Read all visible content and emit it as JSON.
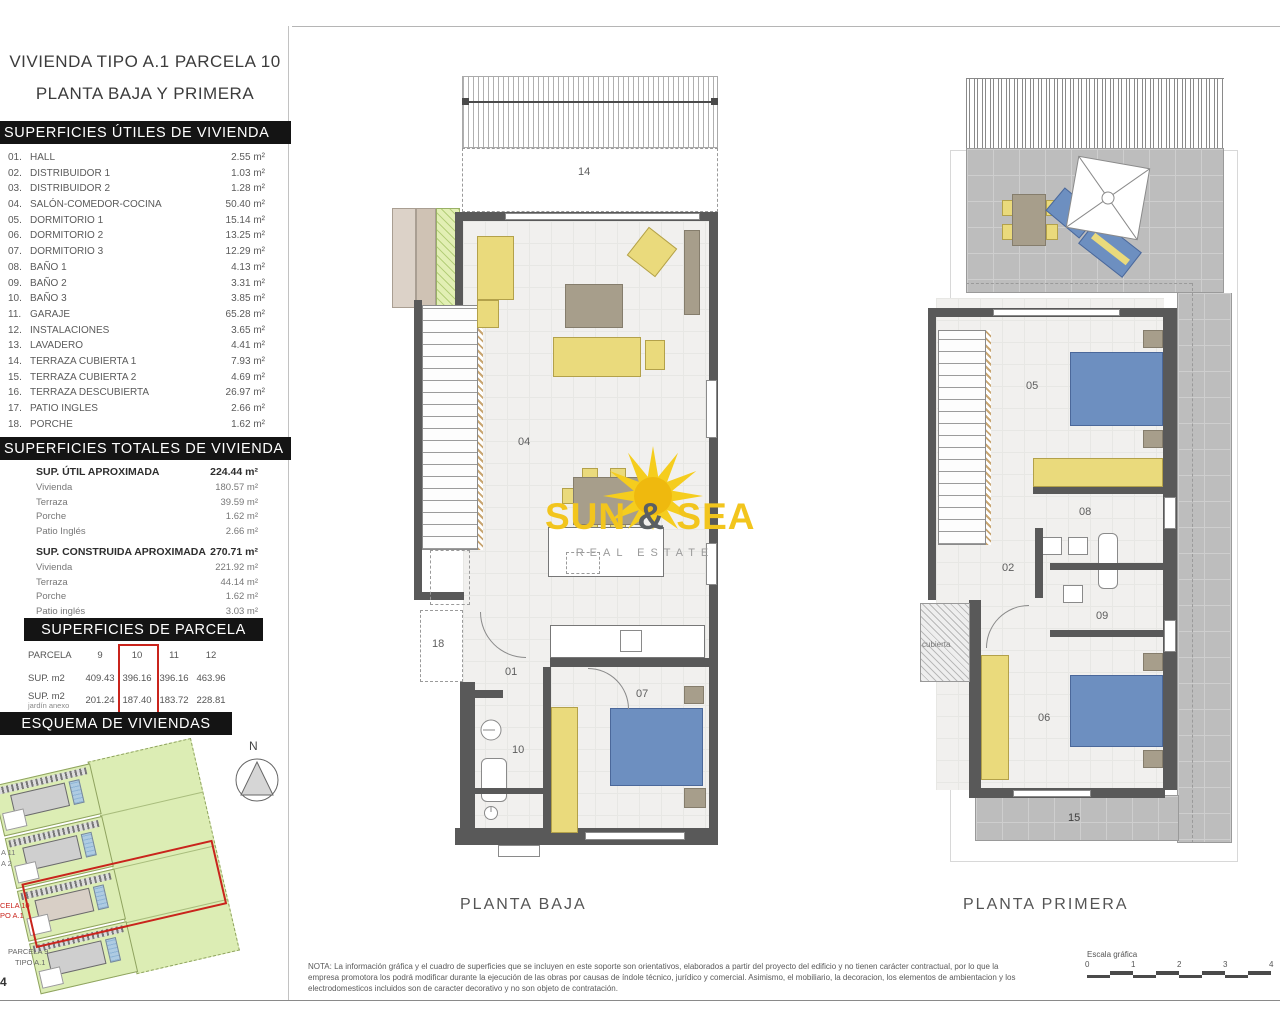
{
  "page": {
    "number": "4"
  },
  "title": {
    "line1": "VIVIENDA TIPO A.1 PARCELA 10",
    "line2": "PLANTA BAJA Y PRIMERA"
  },
  "superficies_utiles": {
    "header": "SUPERFICIES ÚTILES DE VIVIENDA",
    "rooms": [
      {
        "num": "01.",
        "name": "HALL",
        "area": "2.55 m²"
      },
      {
        "num": "02.",
        "name": "DISTRIBUIDOR 1",
        "area": "1.03 m²"
      },
      {
        "num": "03.",
        "name": "DISTRIBUIDOR 2",
        "area": "1.28 m²"
      },
      {
        "num": "04.",
        "name": "SALÓN-COMEDOR-COCINA",
        "area": "50.40 m²"
      },
      {
        "num": "05.",
        "name": "DORMITORIO 1",
        "area": "15.14 m²"
      },
      {
        "num": "06.",
        "name": "DORMITORIO 2",
        "area": "13.25 m²"
      },
      {
        "num": "07.",
        "name": "DORMITORIO 3",
        "area": "12.29 m²"
      },
      {
        "num": "08.",
        "name": "BAÑO 1",
        "area": "4.13 m²"
      },
      {
        "num": "09.",
        "name": "BAÑO 2",
        "area": "3.31 m²"
      },
      {
        "num": "10.",
        "name": "BAÑO 3",
        "area": "3.85 m²"
      },
      {
        "num": "11.",
        "name": "GARAJE",
        "area": "65.28 m²"
      },
      {
        "num": "12.",
        "name": "INSTALACIONES",
        "area": "3.65 m²"
      },
      {
        "num": "13.",
        "name": "LAVADERO",
        "area": "4.41 m²"
      },
      {
        "num": "14.",
        "name": "TERRAZA CUBIERTA 1",
        "area": "7.93 m²"
      },
      {
        "num": "15.",
        "name": "TERRAZA CUBIERTA 2",
        "area": "4.69 m²"
      },
      {
        "num": "16.",
        "name": "TERRAZA DESCUBIERTA",
        "area": "26.97 m²"
      },
      {
        "num": "17.",
        "name": "PATIO INGLES",
        "area": "2.66 m²"
      },
      {
        "num": "18.",
        "name": "PORCHE",
        "area": "1.62 m²"
      }
    ]
  },
  "superficies_totales": {
    "header": "SUPERFICIES TOTALES DE VIVIENDA",
    "util": {
      "label": "SUP. ÚTIL APROXIMADA",
      "value": "224.44 m²",
      "rows": [
        {
          "label": "Vivienda",
          "value": "180.57 m²"
        },
        {
          "label": "Terraza",
          "value": "39.59 m²"
        },
        {
          "label": "Porche",
          "value": "1.62 m²"
        },
        {
          "label": "Patio Inglés",
          "value": "2.66 m²"
        }
      ]
    },
    "construida": {
      "label": "SUP. CONSTRUIDA APROXIMADA",
      "value": "270.71 m²",
      "rows": [
        {
          "label": "Vivienda",
          "value": "221.92 m²"
        },
        {
          "label": "Terraza",
          "value": "44.14 m²"
        },
        {
          "label": "Porche",
          "value": "1.62 m²"
        },
        {
          "label": "Patio inglés",
          "value": "3.03 m²"
        }
      ]
    }
  },
  "superficies_parcela": {
    "header": "SUPERFICIES DE PARCELA",
    "row1_label": "PARCELA",
    "row2_label": "SUP. m2",
    "row3_label": "SUP. m2",
    "row3_sublabel": "jardín anexo",
    "columns": [
      "9",
      "10",
      "11",
      "12"
    ],
    "sup_m2": [
      "409.43",
      "396.16",
      "396.16",
      "463.96"
    ],
    "sup_m2_jardin": [
      "201.24",
      "187.40",
      "183.72",
      "228.81"
    ],
    "highlighted_column": "10"
  },
  "esquema": {
    "header": "ESQUEMA DE VIVIENDAS",
    "compass_label": "N",
    "label_frag_1": "A 11",
    "label_frag_2": "A 2",
    "label_parcela10_line1": "CELA 10",
    "label_parcela10_line2": "PO A.1",
    "label_parcela9_line1": "PARCELA 9",
    "label_parcela9_line2": "TIPO A.1"
  },
  "planta_baja": {
    "caption": "PLANTA BAJA",
    "rooms": {
      "terraza_cubierta": "14",
      "salon": "04",
      "patio_ingles": "18",
      "hall": "01",
      "bano": "10",
      "dormitorio3": "07"
    }
  },
  "planta_primera": {
    "caption": "PLANTA PRIMERA",
    "rooms": {
      "terraza_descubierta": "16",
      "dormitorio1": "05",
      "bano1": "08",
      "distribuidor": "02",
      "bano2": "09",
      "dormitorio2": "06",
      "terraza_cubierta2": "15"
    },
    "cubierta_label": "cubierta"
  },
  "watermark": {
    "sun": "SUN",
    "amp": "&",
    "sea": "SEA",
    "subtitle": "REAL ESTATE"
  },
  "nota": {
    "line1": "NOTA: La información gráfica y el cuadro de superficies que se incluyen en este soporte son orientativos, elaborados a partir del proyecto del edificio y no tienen carácter contractual, por lo que la",
    "line2": "empresa promotora los podrá modificar durante la ejecución de las obras por causas de índole técnico, jurídico y comercial. Asimismo, el mobiliario, la decoracion, los elementos de ambientacion y los",
    "line3": "electrodomesticos incluidos son de caracter decorativo y no son objeto de contratación."
  },
  "escala": {
    "label": "Escala gráfica",
    "ticks": [
      "0",
      "1",
      "2",
      "3",
      "4"
    ]
  },
  "colors": {
    "accent_red": "#c9241c",
    "header_black": "#141414",
    "furniture_yellow": "#eada7c",
    "bed_blue": "#6d8fc0",
    "site_green": "#dcedb4",
    "terrace_gray": "#bdbdbd",
    "sun_yellow": "#f2c51d"
  }
}
